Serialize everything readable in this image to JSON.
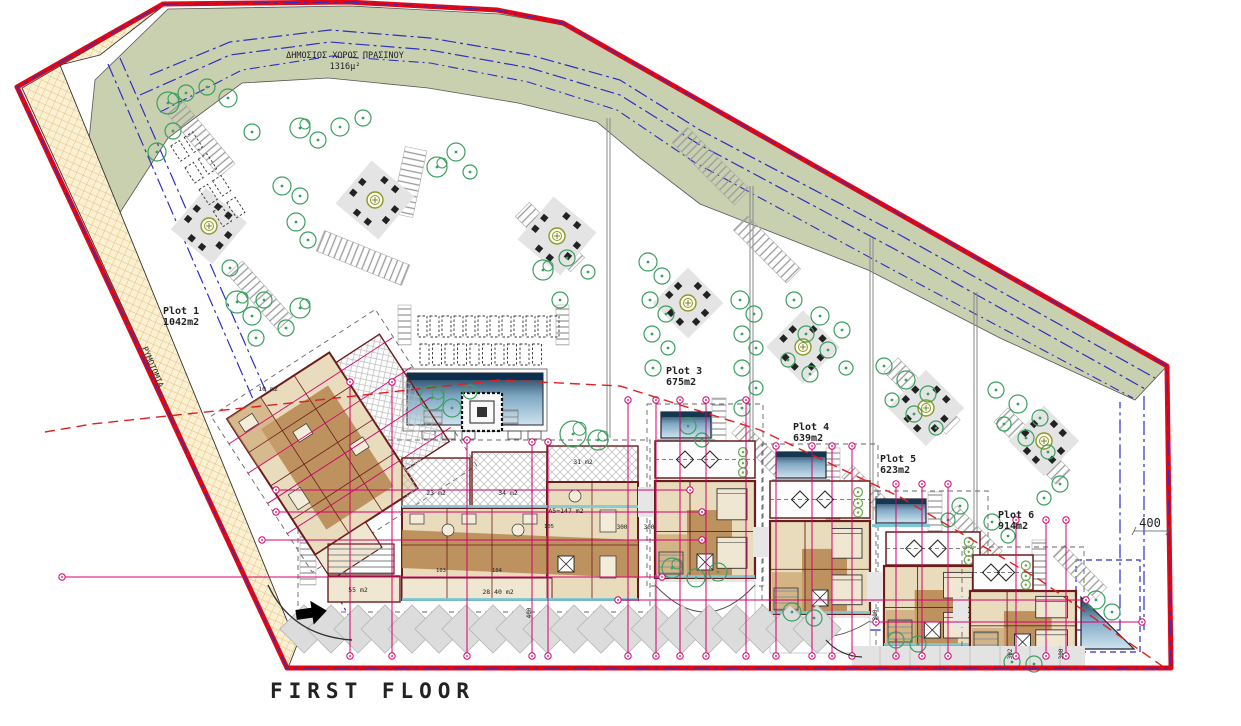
{
  "title": "FIRST FLOOR",
  "green_space": {
    "name": "ΔΗΜΟΣΙΟΣ ΧΩΡΟΣ ΠΡΑΣΙΝΟΥ",
    "area": "1316μ²"
  },
  "road_label": "ΡΥΜΟΤΟΜΙΑ",
  "plots": [
    {
      "name": "Plot 1",
      "area": "1042m2"
    },
    {
      "name": "Plot 3",
      "area": "675m2"
    },
    {
      "name": "Plot 4",
      "area": "639m2"
    },
    {
      "name": "Plot 5",
      "area": "623m2"
    },
    {
      "name": "Plot 6",
      "area": "914m2"
    }
  ],
  "rooms": [
    {
      "label": "23 m2"
    },
    {
      "label": "34 m2"
    },
    {
      "label": "31 m2"
    },
    {
      "label": "55 m2"
    },
    {
      "label": "28.40 m2"
    },
    {
      "label": "A5=147 m2"
    },
    {
      "label": "10 m2"
    }
  ],
  "units": [
    {
      "label": "103"
    },
    {
      "label": "104"
    },
    {
      "label": "105"
    }
  ],
  "dimensions": [
    {
      "label": "400"
    },
    {
      "label": "400"
    },
    {
      "label": "300"
    },
    {
      "label": "300"
    },
    {
      "label": "300"
    },
    {
      "label": "302"
    },
    {
      "label": "300"
    }
  ],
  "colors": {
    "boundary": "#e30613",
    "green_area": "#c9d0b0",
    "road_fill": "#faf0d4",
    "dimension": "#d6006e",
    "blue_line": "#2f2fc1",
    "tree": "#3aa060",
    "wall": "#6b1d1d",
    "floor_tan": "#e8dcbd",
    "floor_brown": "#b5854f",
    "pool_dark": "#17364f",
    "pool_light": "#cfe3ef"
  }
}
